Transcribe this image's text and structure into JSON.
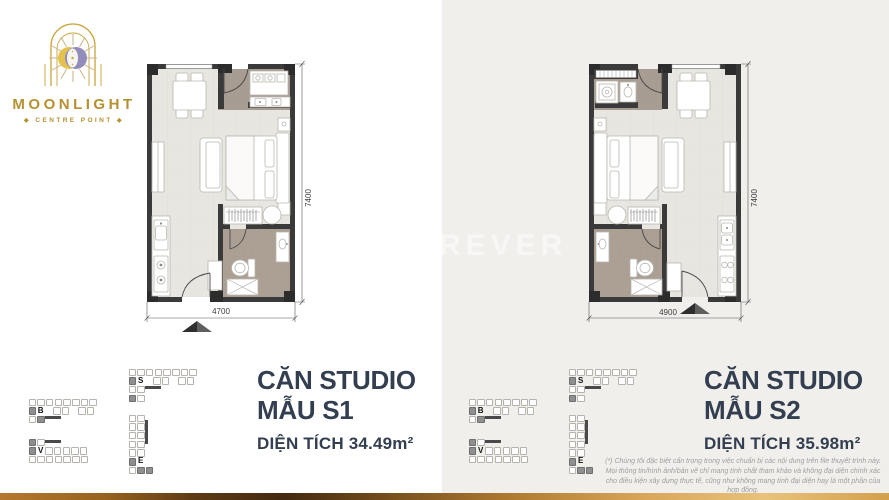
{
  "branding": {
    "name": "MOONLIGHT",
    "tagline": "◆ CENTRE POINT ◆"
  },
  "watermark": {
    "text": "REVER"
  },
  "plans": [
    {
      "title_line1": "CĂN STUDIO",
      "title_line2": "MẪU S1",
      "area_label": "DIỆN TÍCH 34.49m²",
      "width_dim": "4700",
      "height_dim": "7400"
    },
    {
      "title_line1": "CĂN STUDIO",
      "title_line2": "MẪU S2",
      "area_label": "DIỆN TÍCH 35.98m²",
      "width_dim": "4900",
      "height_dim": "7400"
    }
  ],
  "key_plans": {
    "towers": [
      "S",
      "B",
      "V",
      "E"
    ]
  },
  "disclaimer": "(*) Chúng tôi đặc biệt cẩn trọng trong việc chuẩn bị các nội dung trên file thuyết trình này. Mọi thông tin/hình ảnh/bản vẽ chỉ mang tính chất tham khảo và không đại diện chính xác cho điều kiện xây dựng thực tế, cũng như không mang tính đại diện hay là một phần của hợp đồng.",
  "colors": {
    "gold": "#b5912f",
    "title_navy": "#333f50",
    "wall": "#3a3a3a",
    "bath_brown": "#a89d92",
    "panel_gray": "#f1efec"
  }
}
